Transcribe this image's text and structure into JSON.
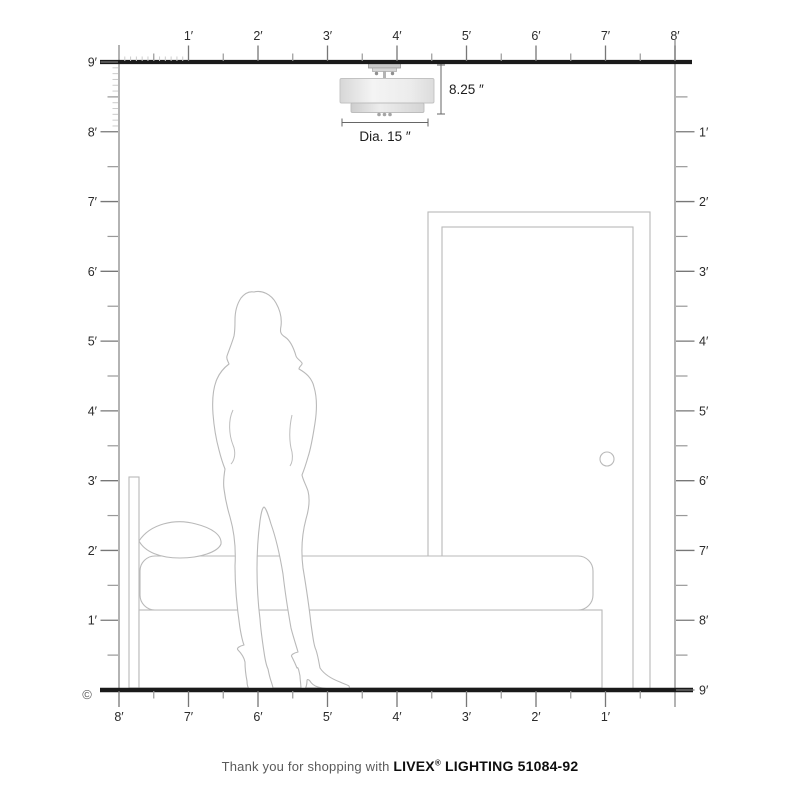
{
  "scene": {
    "copyright_symbol": "©",
    "rulers": {
      "top_labels": [
        "1′",
        "2′",
        "3′",
        "4′",
        "5′",
        "6′",
        "7′",
        "8′"
      ],
      "left_labels": [
        "9′",
        "8′",
        "7′",
        "6′",
        "5′",
        "4′",
        "3′",
        "2′",
        "1′"
      ],
      "right_labels": [
        "1′",
        "2′",
        "3′",
        "4′",
        "5′",
        "6′",
        "7′",
        "8′",
        "9′"
      ],
      "bottom_labels": [
        "8′",
        "7′",
        "6′",
        "5′",
        "4′",
        "3′",
        "2′",
        "1′"
      ]
    },
    "fixture": {
      "height_label": "8.25 ″",
      "diameter_label": "Dia. 15 ″"
    },
    "colors": {
      "frame_line": "#1a1a1a",
      "ruler_line": "#8a8a8a",
      "tick_major": "#777777",
      "tick_half": "#999999",
      "tick_inch": "#cccccc",
      "label_text": "#2b2b2b",
      "outline_gray": "#b9b9b9",
      "dimension_line": "#666666"
    }
  },
  "caption": {
    "prefix": "Thank you for shopping with ",
    "brand": "LIVEX",
    "registered": "®",
    "suffix": " LIGHTING 51084-92"
  }
}
